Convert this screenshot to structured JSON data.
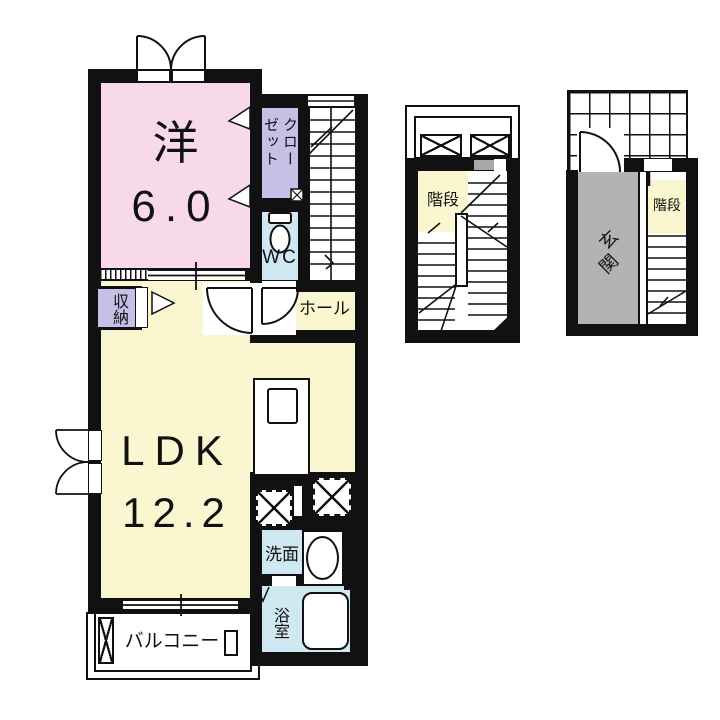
{
  "page": {
    "background": "#ffffff"
  },
  "colors": {
    "wall": "#111111",
    "western_room_fill": "#f8d9e9",
    "ldk_fill": "#faf6cf",
    "closet_fill": "#c6c0e7",
    "wet_area_fill": "#cfe8f2",
    "entrance_fill": "#b3b3b3"
  },
  "unit": {
    "western_room": {
      "name": "洋",
      "size": "6.0"
    },
    "closet": {
      "label": "クローゼット"
    },
    "wc": {
      "label": "WC"
    },
    "hall": {
      "label": "ホール"
    },
    "storage": {
      "label": "収納"
    },
    "ldk": {
      "name": "LDK",
      "size": "12.2"
    },
    "washroom": {
      "label": "洗面"
    },
    "bathroom": {
      "label": "浴室"
    },
    "balcony": {
      "label": "バルコニー"
    }
  },
  "stair_section": {
    "stairs": {
      "label": "階段"
    }
  },
  "entrance_section": {
    "entrance": {
      "label": "玄関"
    },
    "stairs": {
      "label": "階段"
    }
  }
}
